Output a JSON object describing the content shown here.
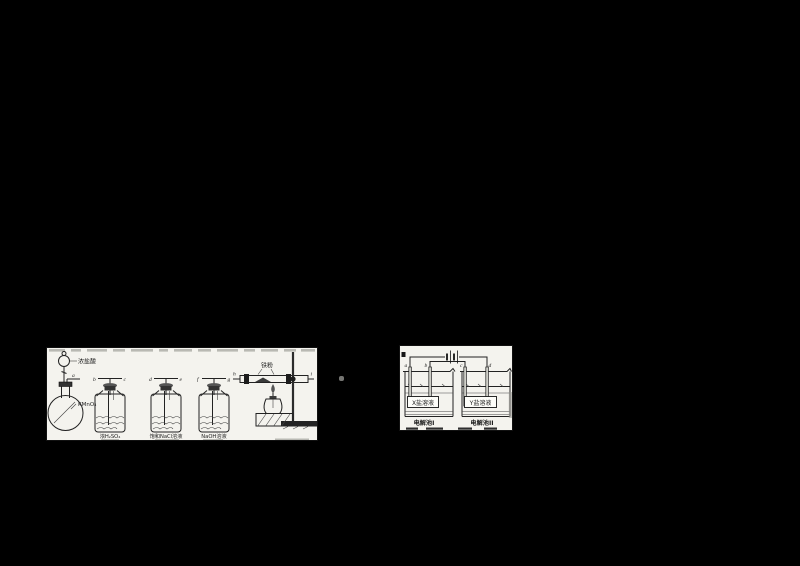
{
  "page": {
    "background_color": "#000000",
    "paper_color": "#f4f3ee",
    "ink_color": "#1a1a1a"
  },
  "left_figure": {
    "funnel_label": "浓盐酸",
    "flask_label": "KMnO₄",
    "port_labels": [
      "a",
      "b",
      "c",
      "d",
      "e",
      "f",
      "g",
      "h",
      "i"
    ],
    "bottle_labels": [
      "浓H₂SO₄",
      "饱和NaCl溶液",
      "NaOH溶液"
    ],
    "tube_label": "铁粉"
  },
  "right_figure": {
    "electrode_labels": [
      "a",
      "b",
      "c",
      "d"
    ],
    "cell1_solution_label": "X盐溶液",
    "cell2_solution_label": "Y盐溶液",
    "cell1_label": "电解池I",
    "cell2_label": "电解池II"
  }
}
